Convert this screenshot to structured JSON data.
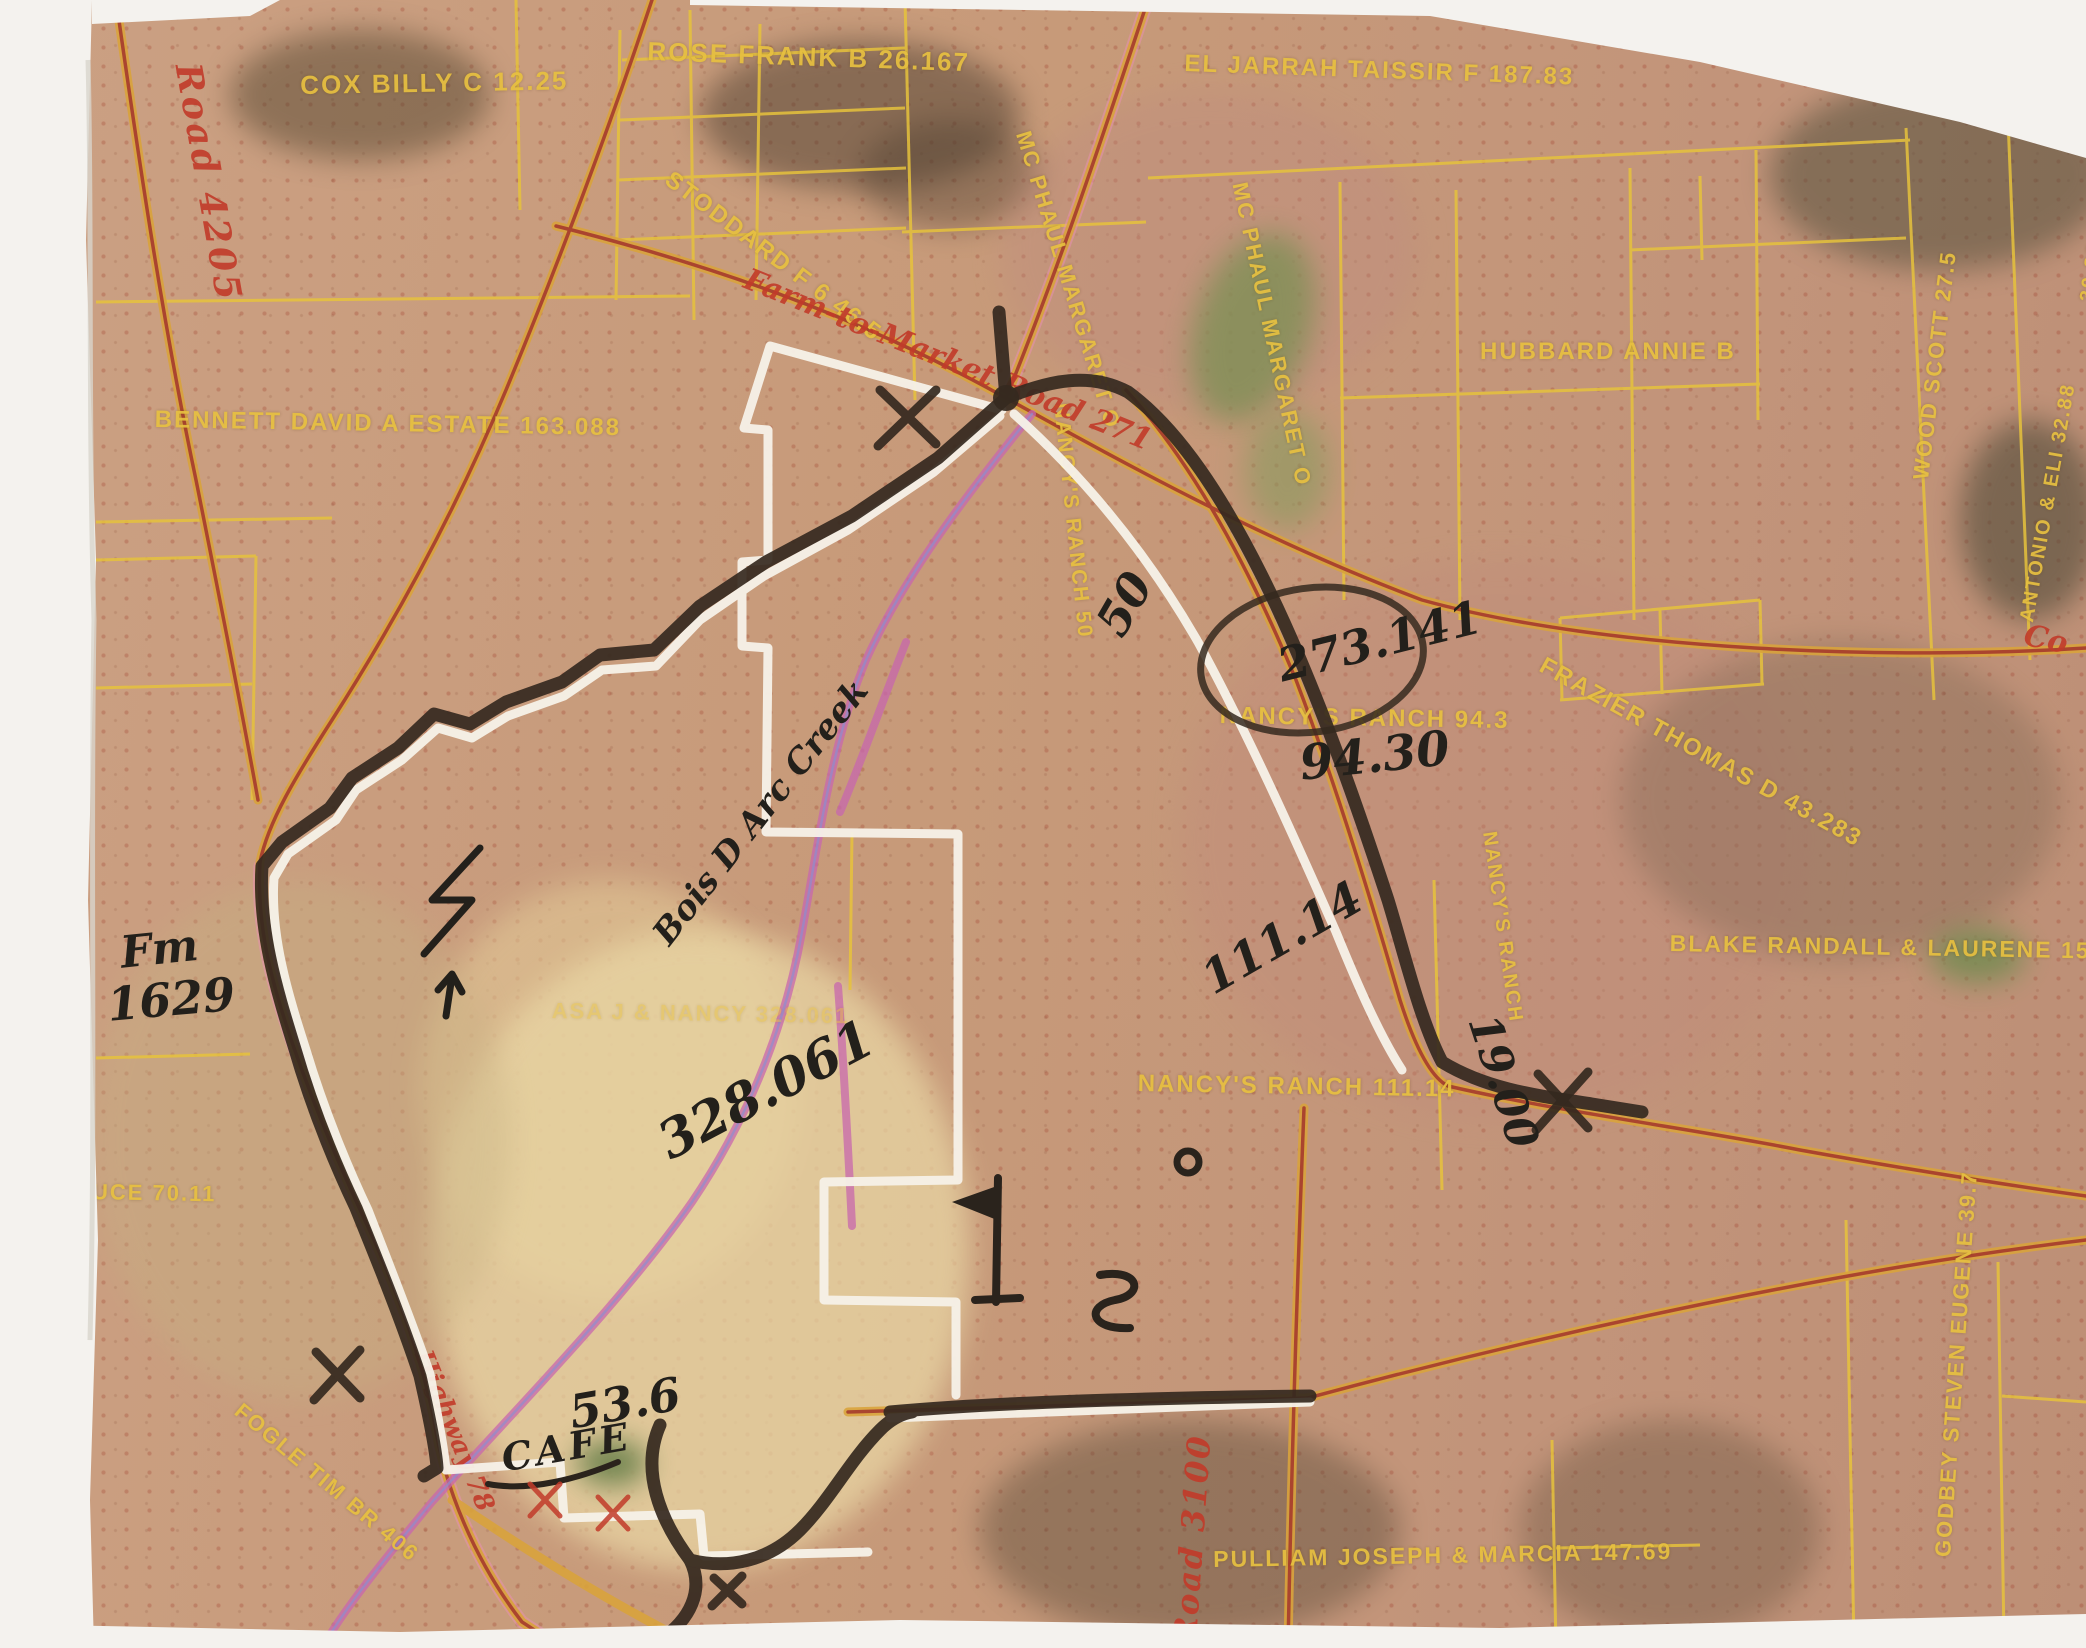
{
  "document": {
    "type": "scanned aerial parcel ownership map with handwritten survey annotations"
  },
  "labels": {
    "cox": "COX BILLY C 12.25",
    "rose": "ROSE FRANK B 26.167",
    "stoddard": "STODDARD F 6 46.5",
    "eljarrah": "EL JARRAH TAISSIR F 187.83",
    "mcphaul_a": "MC PHAUL MARGARET O",
    "mcphaul_b": "MC PHAUL MARGARET O",
    "hubbard": "HUBBARD ANNIE B",
    "scott": "WOOD SCOTT 27.5",
    "antonio": "ANTONIO & ELI 32.88",
    "edge_3083": "30.83",
    "bennett": "BENNETT DAVID A ESTATE 163.088",
    "nancys_50": "NANCY'S RANCH 50",
    "nancys_943": "NANCY'S RANCH 94.3",
    "frazier": "FRAZIER THOMAS D 43.283",
    "blake": "BLAKE RANDALL & LAURENE 155.784",
    "asa_nancy": "ASA J & NANCY 328.061",
    "nancys_111": "NANCY'S RANCH 111.14",
    "nancys_vert": "NANCY'S RANCH",
    "bruce": "M BRUCE 70.11",
    "fogle": "FOGLE TIM BR 406",
    "pulliam": "PULLIAM JOSEPH & MARCIA 147.69",
    "godbey": "GODBEY STEVEN EUGENE 39.7"
  },
  "roads": {
    "road_4205": "Road 4205",
    "fm_271": "Farm-to-Market Road 271",
    "county_fragment": "Co",
    "highway_78": "Highway 78",
    "road_3100": "Road 3100"
  },
  "handwritten": {
    "circled_acreage": "273.141",
    "acreage_9430": "94.30",
    "ranch_50": "50",
    "acreage_328": "328.061",
    "acreage_111": "111.14",
    "acreage_19": "19.00",
    "fm_line1": "Fm",
    "fm_line2": "1629",
    "creek": "Bois D Arc Creek",
    "acreage_536": "53.6",
    "cafe": "CAFE"
  },
  "colors": {
    "map_base": "#c79a79",
    "parcel_line_yellow": "#e6c23c",
    "road_red": "#a8402e",
    "road_casing": "#d9a33c",
    "highlight_pink": "#e98fb3",
    "creek_magenta": "#c867ae",
    "marker_black": "#35291f",
    "boundary_white": "#f7f2e9",
    "printed_label_yellow": "#e7c040",
    "road_label_red": "#c23b2a",
    "handwriting_ink": "#23201b",
    "red_pen": "#c23b2a",
    "paper_white": "#f4f2ee"
  }
}
